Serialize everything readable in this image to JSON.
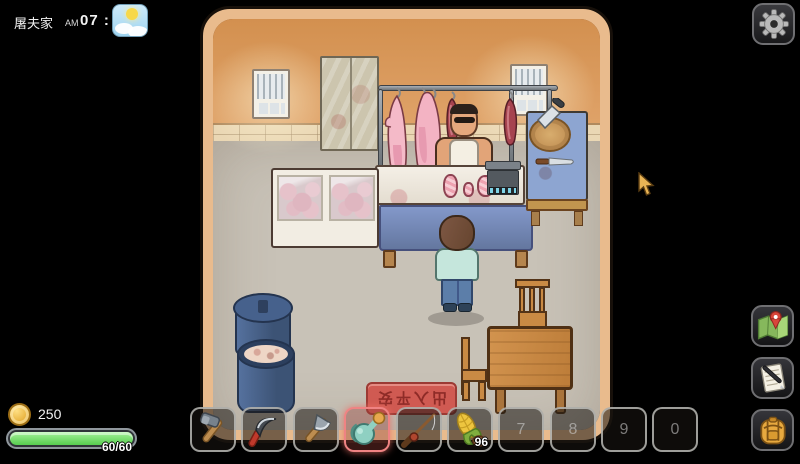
{
  "hud": {
    "location": "屠夫家",
    "time": {
      "meridiem": "AM",
      "value": "07 : 40"
    },
    "weather": "sunny-with-clouds",
    "coins": "250",
    "health": "60/60"
  },
  "side_menu": {
    "buttons": [
      "settings",
      "map",
      "journal",
      "backpack"
    ]
  },
  "hotbar": {
    "selected_slot": 4,
    "slots": [
      {
        "item": "hammer",
        "label": "",
        "count": ""
      },
      {
        "item": "sickle",
        "label": "",
        "count": ""
      },
      {
        "item": "axe",
        "label": "",
        "count": ""
      },
      {
        "item": "watering-can",
        "label": "",
        "count": "",
        "selected": true
      },
      {
        "item": "fishing-rod",
        "label": "",
        "count": ""
      },
      {
        "item": "corn",
        "label": "",
        "count": "96"
      },
      {
        "item": "",
        "label": "7",
        "count": ""
      },
      {
        "item": "",
        "label": "8",
        "count": ""
      },
      {
        "item": "",
        "label": "9",
        "count": ""
      },
      {
        "item": "",
        "label": "0",
        "count": ""
      }
    ]
  },
  "scene": {
    "doormat_text": "出入平安",
    "npc": "butcher",
    "objects": [
      "meat-rack",
      "hanging-pork",
      "display-freezer",
      "counter-scale",
      "cutting-board",
      "barrels",
      "dining-table"
    ]
  },
  "colors": {
    "selected_slot_accent": "#ef8383",
    "health_green": "#57cc4f",
    "coin_gold": "#e3a82e",
    "wall_orange": "#d89a60",
    "doormat_red": "#d05a52"
  }
}
